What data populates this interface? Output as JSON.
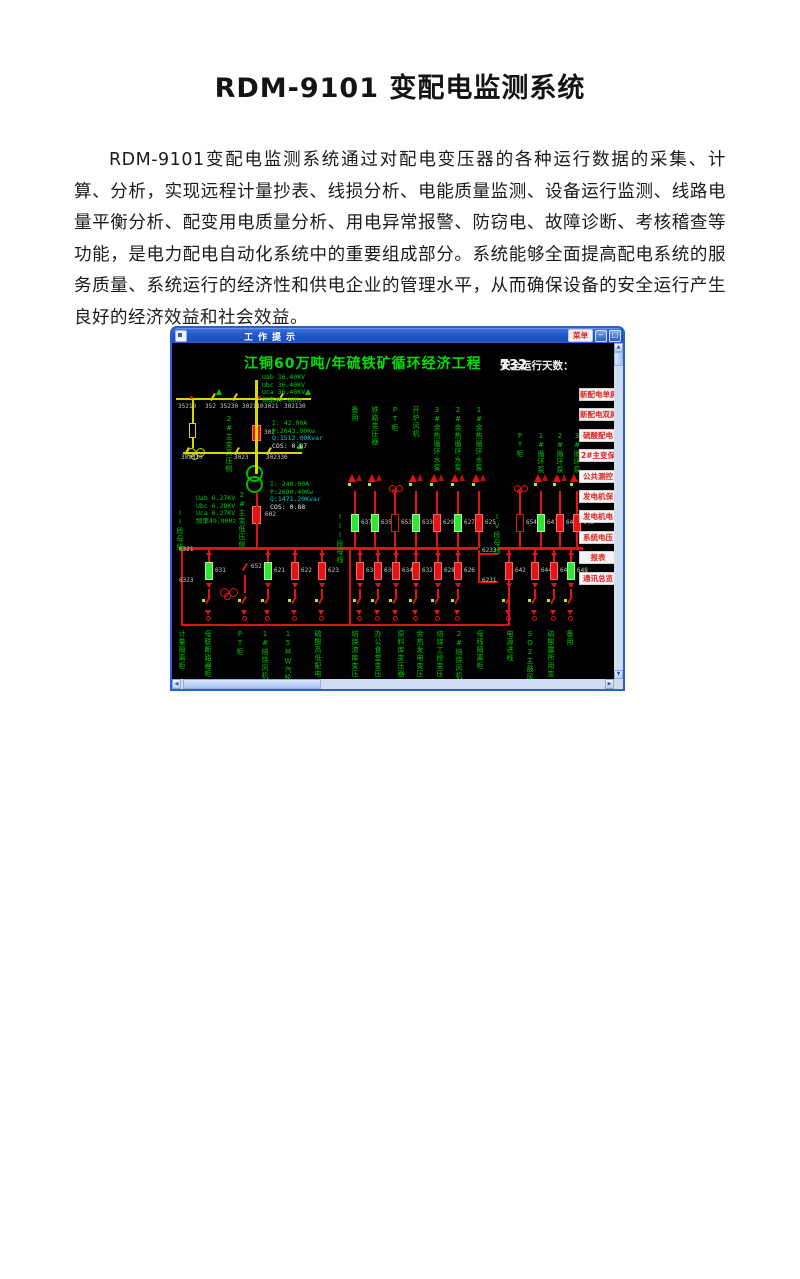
{
  "page": {
    "title": "RDM-9101 变配电监测系统",
    "paragraph": "RDM-9101变配电监测系统通过对配电变压器的各种运行数据的采集、计算、分析，实现远程计量抄表、线损分析、电能质量监测、设备运行监测、线路电量平衡分析、配变用电质量分析、用电异常报警、防窃电、故障诊断、考核稽查等功能，是电力配电自动化系统中的重要组成部分。系统能够全面提高配电系统的服务质量、系统运行的经济性和供电企业的管理水平，从而确保设备的安全运行产生良好的经济效益和社会效益。"
  },
  "window": {
    "title": "工作提示",
    "menu_button": "菜单",
    "minimize_glyph": "−",
    "restore_glyph": "□",
    "scada": {
      "title": "江铜60万吨/年硫铁矿循环经济工程",
      "safe_days_label": "安全运行天数：",
      "safe_days_value": "732",
      "safe_days_unit": "天",
      "colors": {
        "green": "#00cc00",
        "red": "#e11414",
        "cyan": "#00cccc",
        "yellow": "#d8d800",
        "white": "#e8e8e8",
        "button_text": "#e02020"
      },
      "hv_readings": [
        "Uab 36.40KV",
        "Ubc 36.40KV",
        "Uca 36.40KV",
        "频率49.90Hz"
      ],
      "lv_readings": [
        "Uab 6.27KV",
        "Ubc 6.28KV",
        "Uca 6.27KV",
        "频率49.90Hz"
      ],
      "meter_hv": [
        "I:  42.00A",
        "P:2643.90Kw",
        "Q:1512.00Kvar",
        "COS:  0.87"
      ],
      "meter_lv": [
        "I: 240.00A",
        "P:2690.40Kw",
        "Q:1471.20Kvar",
        "COS:  0.88"
      ],
      "xfmr_hv_label": "2#主变高压侧",
      "xfmr_lv_label": "2#主变低压侧",
      "breaker_302": "302",
      "breaker_602": "602",
      "hv_switch_row1": [
        {
          "x": 6,
          "t": "35210"
        },
        {
          "x": 33,
          "t": "352"
        },
        {
          "x": 48,
          "t": "35230"
        },
        {
          "x": 70,
          "t": "302110"
        },
        {
          "x": 92,
          "t": "3021"
        },
        {
          "x": 112,
          "t": "302130"
        }
      ],
      "hv_switch_row2": [
        {
          "x": 9,
          "t": "302310"
        },
        {
          "x": 62,
          "t": "3023"
        },
        {
          "x": 94,
          "t": "302330"
        }
      ],
      "disconnect_labels": [
        {
          "x": 7,
          "y": 204,
          "t": "6321"
        },
        {
          "x": 7,
          "y": 235,
          "t": "6323"
        },
        {
          "x": 310,
          "y": 205,
          "t": "6233"
        },
        {
          "x": 310,
          "y": 235,
          "t": "6231"
        }
      ],
      "bus_section_labels": [
        {
          "x": 4,
          "y": 166,
          "t": "II段母线"
        },
        {
          "x": 164,
          "y": 170,
          "t": "III段母线"
        },
        {
          "x": 321,
          "y": 170,
          "t": "IV段母线"
        }
      ],
      "upper_feeders": [
        {
          "x": 182,
          "num": "637",
          "state": "green",
          "label": "备用"
        },
        {
          "x": 202,
          "num": "635",
          "state": "green",
          "label": "铁路变压器"
        },
        {
          "x": 222,
          "num": "653",
          "state": "pt",
          "label": "PT柜"
        },
        {
          "x": 243,
          "num": "633",
          "state": "green",
          "label": "开炉风机"
        },
        {
          "x": 264,
          "num": "629",
          "state": "red",
          "label": "3#余热循环水泵"
        },
        {
          "x": 285,
          "num": "627",
          "state": "green",
          "label": "2#余热循环水泵"
        },
        {
          "x": 306,
          "num": "625",
          "state": "red",
          "label": "1#余热循环水泵"
        },
        {
          "x": 347,
          "num": "654",
          "state": "pt",
          "label": "PT柜",
          "grp": "iv"
        },
        {
          "x": 368,
          "num": "641",
          "state": "green",
          "label": "1#循环泵",
          "grp": "iv"
        },
        {
          "x": 387,
          "num": "643",
          "state": "red",
          "label": "2#循环泵",
          "grp": "iv"
        },
        {
          "x": 404,
          "num": "645",
          "state": "red",
          "label": "3#循环泵",
          "grp": "iv"
        }
      ],
      "lower_feeders": [
        {
          "x": 36,
          "num": "631",
          "c": "green"
        },
        {
          "x": 72,
          "num": "652",
          "c": "tie"
        },
        {
          "x": 95,
          "num": "621",
          "c": "green"
        },
        {
          "x": 122,
          "num": "622",
          "c": "red"
        },
        {
          "x": 149,
          "num": "623",
          "c": "red"
        },
        {
          "x": 187,
          "num": "638",
          "c": "red"
        },
        {
          "x": 205,
          "num": "636",
          "c": "red"
        },
        {
          "x": 223,
          "num": "634",
          "c": "red"
        },
        {
          "x": 243,
          "num": "632",
          "c": "red"
        },
        {
          "x": 265,
          "num": "628",
          "c": "red"
        },
        {
          "x": 285,
          "num": "626",
          "c": "red"
        },
        {
          "x": 336,
          "num": "642",
          "c": "red"
        },
        {
          "x": 362,
          "num": "644",
          "c": "red"
        },
        {
          "x": 381,
          "num": "646",
          "c": "red"
        },
        {
          "x": 398,
          "num": "648",
          "c": "green"
        }
      ],
      "bottom_labels": [
        {
          "x": 6,
          "t": "计量隔离柜"
        },
        {
          "x": 32,
          "t": "母联断路器柜"
        },
        {
          "x": 64,
          "t": "PT柜"
        },
        {
          "x": 89,
          "t": "1#焙烧风机"
        },
        {
          "x": 112,
          "t": "15MW汽轮发电"
        },
        {
          "x": 142,
          "t": "硫酸高低配电"
        },
        {
          "x": 179,
          "t": "焙烧渣库变压"
        },
        {
          "x": 202,
          "t": "办公食堂变压"
        },
        {
          "x": 225,
          "t": "原料库变压器"
        },
        {
          "x": 244,
          "t": "余热发电变压"
        },
        {
          "x": 264,
          "t": "焙烧工段变压"
        },
        {
          "x": 283,
          "t": "2#焙烧风机"
        },
        {
          "x": 304,
          "t": "母线隔离柜"
        },
        {
          "x": 334,
          "t": "电源进线"
        },
        {
          "x": 354,
          "t": "SO2主鼓风机"
        },
        {
          "x": 375,
          "t": "硫酸露所用变"
        },
        {
          "x": 394,
          "t": "备用"
        }
      ],
      "side_buttons": [
        "新配电单屏",
        "新配电双屏",
        "硫酸配电",
        "2#主变保",
        "公共测控",
        "发电机保",
        "发电机电",
        "系统电压",
        "报表",
        "通讯总览"
      ]
    }
  }
}
